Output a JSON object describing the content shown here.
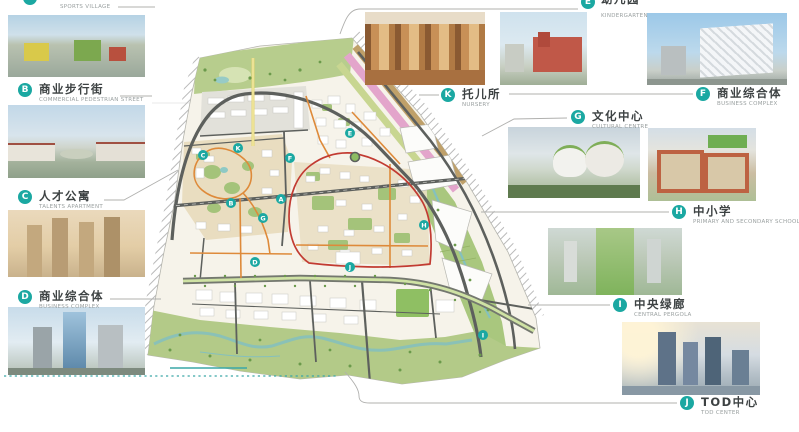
{
  "accent": "#1ba8a2",
  "labels": {
    "A": {
      "letter": "A",
      "subtitle": "SPORTS VILLAGE"
    },
    "B": {
      "letter": "B",
      "title": "商业步行街",
      "subtitle": "COMMERCIAL PEDESTRIAN STREET"
    },
    "C": {
      "letter": "C",
      "title": "人才公寓",
      "subtitle": "TALENTS APARTMENT"
    },
    "D": {
      "letter": "D",
      "title": "商业综合体",
      "subtitle": "BUSINESS COMPLEX"
    },
    "E": {
      "letter": "E",
      "title": "幼儿园",
      "subtitle": "KINDERGARTEN"
    },
    "F": {
      "letter": "F",
      "title": "商业综合体",
      "subtitle": "BUSINESS COMPLEX"
    },
    "G": {
      "letter": "G",
      "title": "文化中心",
      "subtitle": "CULTURAL CENTRE"
    },
    "H": {
      "letter": "H",
      "title": "中小学",
      "subtitle": "PRIMARY AND SECONDARY SCHOOLS"
    },
    "I": {
      "letter": "I",
      "title": "中央绿廊",
      "subtitle": "CENTRAL PERGOLA"
    },
    "J": {
      "letter": "J",
      "title": "TOD中心",
      "subtitle": "TOD CENTER"
    },
    "K": {
      "letter": "K",
      "title": "托儿所",
      "subtitle": "NURSERY"
    }
  },
  "map": {
    "marker_color": "#1ba8a2",
    "markers": [
      {
        "letter": "A",
        "x": 281,
        "y": 199
      },
      {
        "letter": "B",
        "x": 231,
        "y": 203
      },
      {
        "letter": "C",
        "x": 203,
        "y": 155
      },
      {
        "letter": "D",
        "x": 255,
        "y": 262
      },
      {
        "letter": "E",
        "x": 350,
        "y": 133
      },
      {
        "letter": "F",
        "x": 290,
        "y": 158
      },
      {
        "letter": "G",
        "x": 263,
        "y": 218
      },
      {
        "letter": "H",
        "x": 424,
        "y": 225
      },
      {
        "letter": "I",
        "x": 483,
        "y": 335
      },
      {
        "letter": "J",
        "x": 350,
        "y": 267
      },
      {
        "letter": "K",
        "x": 238,
        "y": 148
      }
    ],
    "colors": {
      "red_road": "#c23b32",
      "orange_road": "#de8a3a",
      "green_corridor": "#8dbd62",
      "water": "#85c0bd",
      "pink_band": "#e3a5cb",
      "tan_band": "#bfa069"
    }
  }
}
